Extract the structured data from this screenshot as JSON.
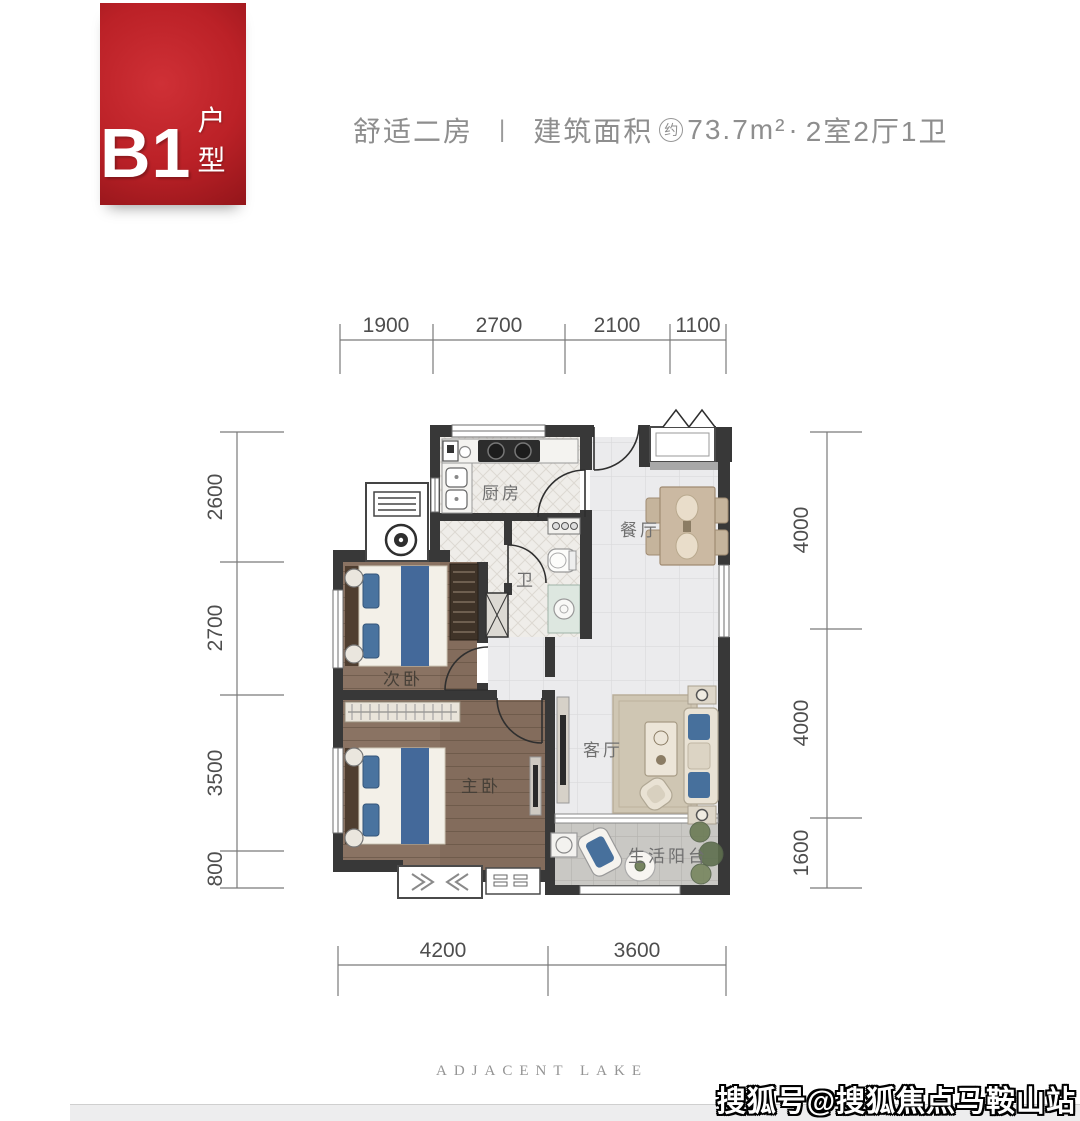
{
  "badge": {
    "code": "B1",
    "type_label": "户型"
  },
  "header": {
    "subtitle": "舒适二房",
    "divider": "|",
    "area_label": "建筑面积",
    "approx": "约",
    "area_value": "73.7m²",
    "dot": "·",
    "layout": "2室2厅1卫"
  },
  "plan": {
    "rooms": {
      "kitchen": "厨房",
      "dining": "餐厅",
      "bath": "卫",
      "bedroom_second": "次卧",
      "bedroom_master": "主卧",
      "living": "客厅",
      "balcony": "生活阳台"
    },
    "dims_top": [
      "1900",
      "2700",
      "2100",
      "1100"
    ],
    "dims_left": [
      "2600",
      "2700",
      "3500",
      "800"
    ],
    "dims_right": [
      "4000",
      "4000",
      "1600"
    ],
    "dims_bottom": [
      "4200",
      "3600"
    ]
  },
  "footer": {
    "brand": "ADJACENT LAKE",
    "watermark": "搜狐号@搜狐焦点马鞍山站"
  },
  "colors": {
    "badge_red": "#bb2127",
    "wall": "#383838",
    "wood_floor": "#8a7363",
    "tile_floor": "#ebebed",
    "accent_blue": "#4a74a1"
  }
}
